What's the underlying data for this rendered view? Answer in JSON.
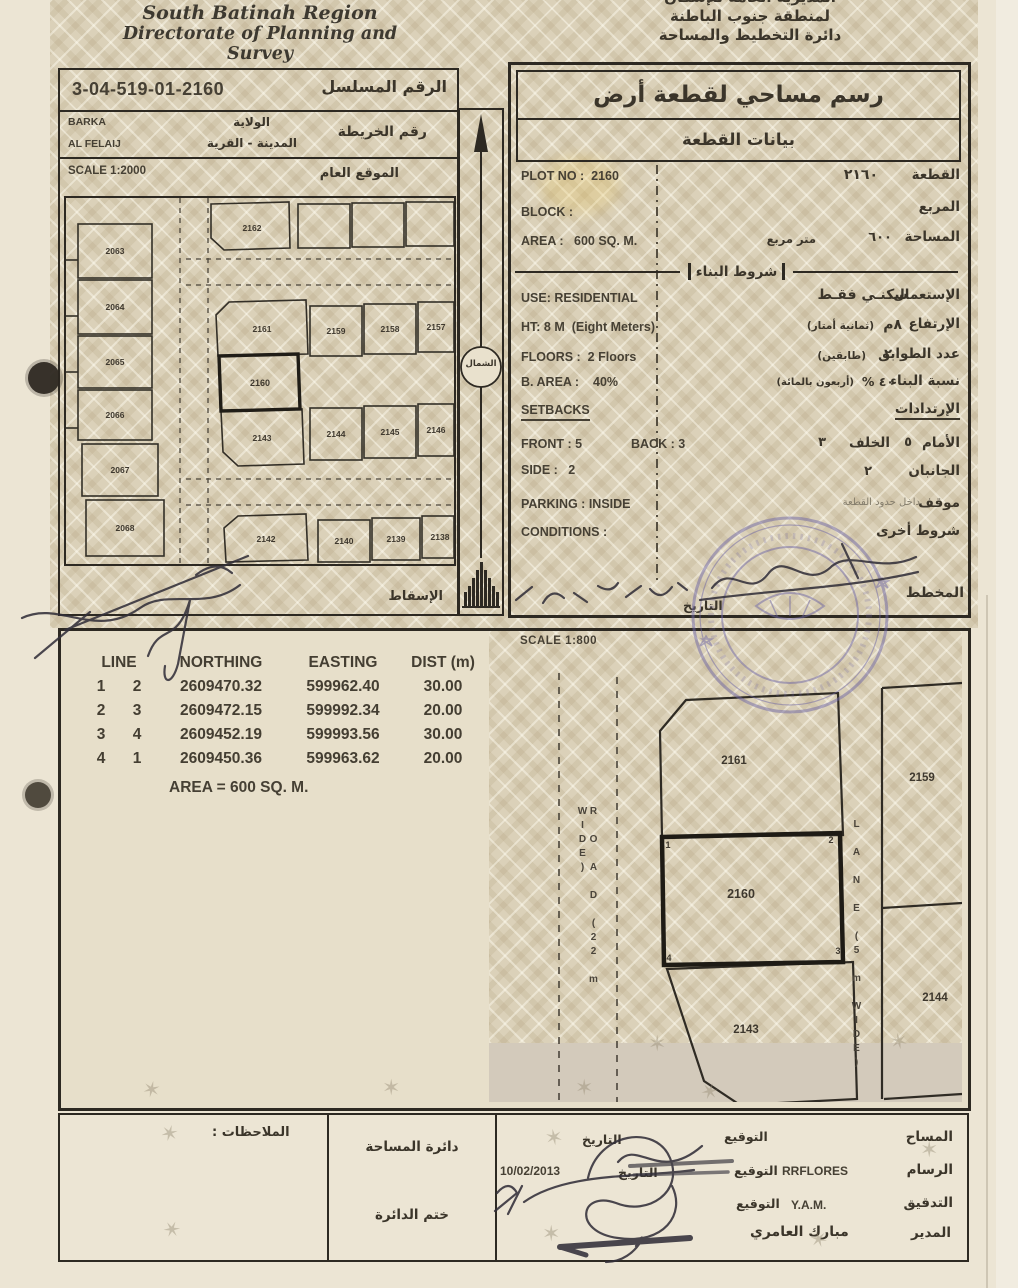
{
  "header": {
    "en_line1": "South Batinah Region",
    "en_line2": "Directorate of Planning and Survey",
    "ar_line1": "المديرية العامة للإسكان",
    "ar_line2": "لمنطقة جنوب الباطنة",
    "ar_line3": "دائرة التخطيط والمساحة"
  },
  "serial": {
    "label_ar": "الرقم المسلسل",
    "value": "3-04-519-01-2160"
  },
  "location": {
    "wilaya_value": "BARKA",
    "wilaya_label_ar": "الولاية",
    "town_value": "AL FELAIJ",
    "town_label_ar": "المدينة - القرية",
    "map_label_ar": "رقم الخريطة"
  },
  "site_plan": {
    "scale": "SCALE 1:2000",
    "title_ar": "الموقع العام",
    "projection_ar": "الإسقاط",
    "north_ar": "الشمال",
    "plots": [
      "2162",
      "2063",
      "2064",
      "2065",
      "2066",
      "2067",
      "2068",
      "2161",
      "2159",
      "2158",
      "2157",
      "2160",
      "2143",
      "2144",
      "2145",
      "2146",
      "2142",
      "2140",
      "2139",
      "2138"
    ]
  },
  "plot_info": {
    "title_ar": "رسم مساحي لقطعة أرض",
    "subtitle_ar": "بيانات القطعة",
    "plot_no_en": "PLOT NO :  2160",
    "plot_label_ar": "القطعة",
    "plot_value_ar": "٢١٦٠",
    "block_en": "BLOCK :",
    "block_label_ar": "المربع",
    "area_en": "AREA :   600 SQ. M.",
    "area_label_ar": "المساحة",
    "area_value_ar": "٦٠٠",
    "area_unit_ar": "متر مربع",
    "building_terms_ar": "شروط البناء",
    "use_en": "USE: RESIDENTIAL",
    "use_label_ar": "الإستعمال",
    "use_value_ar": "سكنـي فقـط",
    "height_en": "HT: 8 M  (Eight Meters)",
    "height_label_ar": "الإرتفاع",
    "height_value_ar": "٨م",
    "height_note_ar": "(ثمانية أمتار)",
    "floors_en": "FLOORS :  2 Floors",
    "floors_label_ar": "عدد الطوابق",
    "floors_value_ar": "٢",
    "floors_note_ar": "(طابقين)",
    "barea_en": "B. AREA :    40%",
    "barea_label_ar": "نسبة البناء",
    "barea_value_ar": "٤٠ %",
    "barea_note_ar": "(أربعون بالمائة)",
    "setbacks_en": "SETBACKS",
    "setbacks_label_ar": "الإرتدادات",
    "front_en": "FRONT : 5",
    "back_en": "BACK : 3",
    "front_label_ar": "الأمام",
    "front_value_ar": "٥",
    "back_label_ar": "الخلف",
    "back_value_ar": "٣",
    "side_en": "SIDE :   2",
    "side_label_ar": "الجانبان",
    "side_value_ar": "٢",
    "parking_en": "PARKING : INSIDE",
    "parking_label_ar": "موقف",
    "parking_value_ar": "داخل حدود القطعة",
    "conditions_en": "CONDITIONS :",
    "conditions_label_ar": "شروط أخرى",
    "planner_label_ar": "المخطط",
    "date_label_ar": "التاريخ"
  },
  "survey": {
    "scale": "SCALE 1:800",
    "table": {
      "col_line": "LINE",
      "col_northing": "NORTHING",
      "col_easting": "EASTING",
      "col_dist": "DIST (m)",
      "rows": [
        {
          "from": "1",
          "to": "2",
          "northing": "2609470.32",
          "easting": "599962.40",
          "dist": "30.00"
        },
        {
          "from": "2",
          "to": "3",
          "northing": "2609472.15",
          "easting": "599992.34",
          "dist": "20.00"
        },
        {
          "from": "3",
          "to": "4",
          "northing": "2609452.19",
          "easting": "599993.56",
          "dist": "30.00"
        },
        {
          "from": "4",
          "to": "1",
          "northing": "2609450.36",
          "easting": "599963.62",
          "dist": "20.00"
        }
      ],
      "area_note": "AREA = 600 SQ. M."
    },
    "drawing": {
      "road_label": "R O A D  (22 m WIDE)",
      "lane_label": "L A N E  (5 m WIDE)",
      "plot_2161": "2161",
      "plot_2159": "2159",
      "plot_2160": "2160",
      "plot_2144": "2144",
      "plot_2143": "2143",
      "corner_1": "1",
      "corner_2": "2",
      "corner_3": "3",
      "corner_4": "4"
    }
  },
  "footer": {
    "notes_label_ar": "الملاحظات :",
    "dept_label_ar": "دائرة المساحة",
    "dept_stamp_ar": "ختم الدائرة",
    "surveyor_label_ar": "المساح",
    "draftsman_label_ar": "الرسام",
    "draftsman_value": "RRFLORES",
    "check_label_ar": "التدقيق",
    "check_value": "Y.A.M.",
    "director_label_ar": "المدير",
    "director_value_ar": "مبارك العامري",
    "sign_label_ar": "التوقيع",
    "date_label_ar": "التاريخ",
    "date_value": "10/02/2013"
  }
}
